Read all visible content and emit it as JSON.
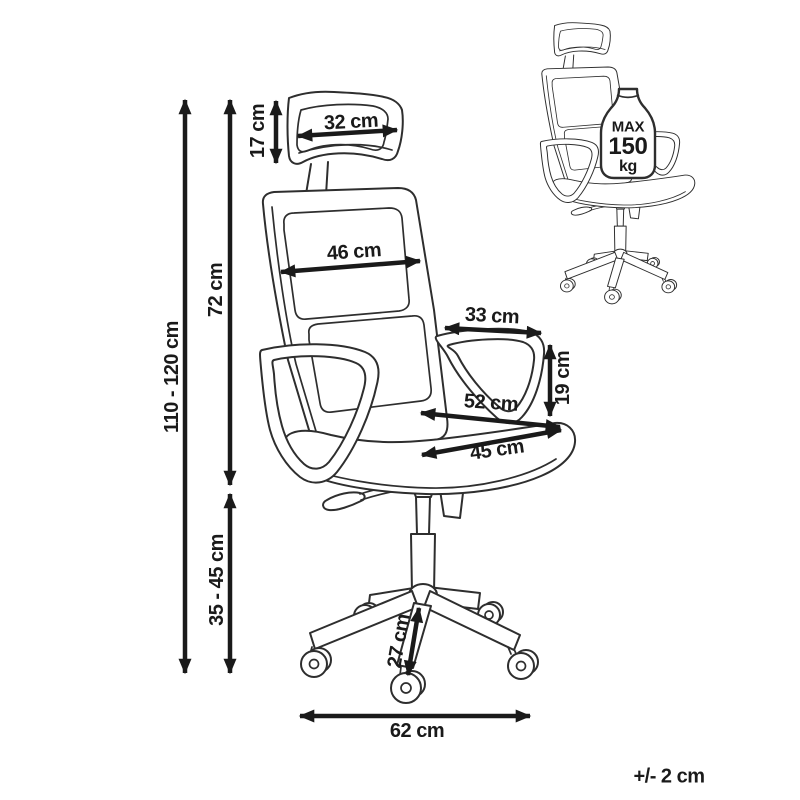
{
  "colors": {
    "background": "#ffffff",
    "artwork_line": "#2e2e2e",
    "dimension_ink": "#1a1a1a"
  },
  "dimensions": {
    "total_height": "110 - 120 cm",
    "backrest_height": "72 cm",
    "seat_height": "35 - 45 cm",
    "headrest_height": "17 cm",
    "headrest_width": "32 cm",
    "backrest_width": "46 cm",
    "armrest_depth": "33 cm",
    "armrest_height": "19 cm",
    "seat_depth": "52 cm",
    "seat_width": "45 cm",
    "base_leg_length": "27 cm",
    "base_width": "62 cm"
  },
  "weight_limit": {
    "max_label": "MAX",
    "value": "150",
    "unit": "kg"
  },
  "tolerance_note": "+/- 2 cm"
}
